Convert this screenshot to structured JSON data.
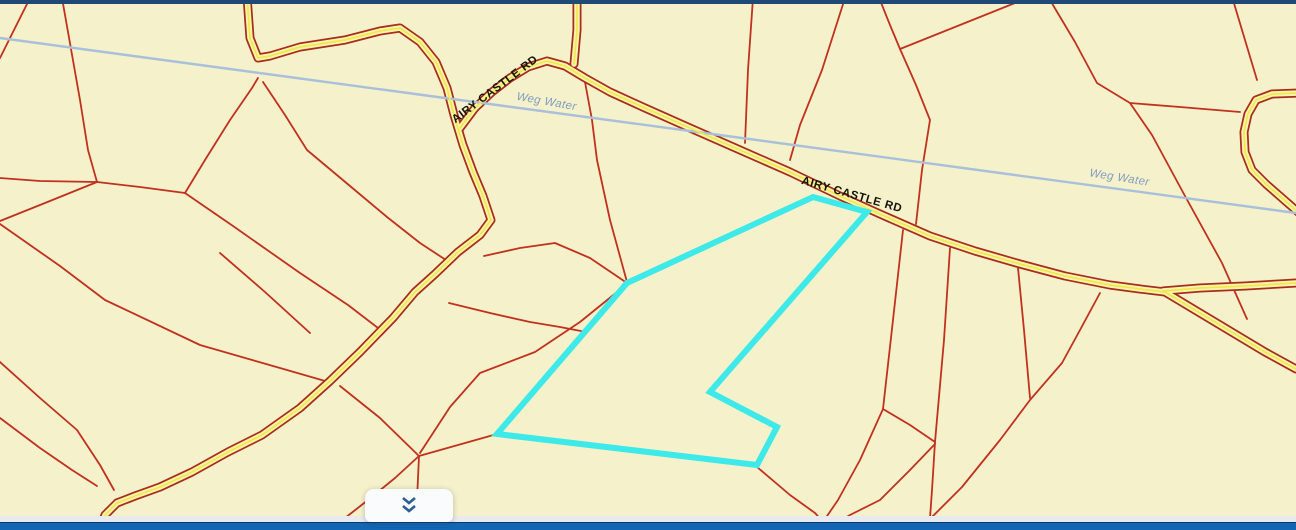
{
  "app": {
    "type": "parcel-map-viewer"
  },
  "colors": {
    "map_background": "#f5f1cb",
    "parcel_line": "#c0311f",
    "road_casing": "#a82d1c",
    "road_fill": "#f9f3ae",
    "road_centerline": "#f0e94c",
    "water_line": "#a9c0da",
    "water_label": "#7f9dc0",
    "road_label": "#141407",
    "highlight_parcel": "#3ee9e9",
    "top_bar": "#1f4a76",
    "panel_edge": "#e9eaee",
    "bottom_bar": "#1366b4",
    "bottom_bar_border": "#0a3a6e",
    "button_background": "#fafbfd",
    "chevron_icon": "#2d5f92"
  },
  "map": {
    "labels": [
      {
        "text": "AIRY CASTLE RD",
        "x": 497,
        "y": 92,
        "angle": -37,
        "kind": "road",
        "size": 11.5
      },
      {
        "text": "AIRY CASTLE RD",
        "x": 851,
        "y": 198,
        "angle": 16,
        "kind": "road",
        "size": 11.5
      },
      {
        "text": "Weg Water",
        "x": 546,
        "y": 105,
        "angle": 10,
        "kind": "water",
        "size": 11.5
      },
      {
        "text": "Weg Water",
        "x": 1119,
        "y": 181,
        "angle": 9,
        "kind": "water",
        "size": 11.5
      }
    ],
    "water": [
      [
        0,
        38
      ],
      [
        430,
        96
      ],
      [
        690,
        131
      ],
      [
        1000,
        173
      ],
      [
        1296,
        213
      ]
    ],
    "roads": [
      [
        [
          247,
          -4
        ],
        [
          250,
          38
        ],
        [
          258,
          58
        ],
        [
          270,
          56
        ],
        [
          300,
          47
        ],
        [
          345,
          40
        ],
        [
          380,
          31
        ],
        [
          400,
          28
        ],
        [
          420,
          42
        ],
        [
          436,
          62
        ],
        [
          447,
          88
        ],
        [
          454,
          115
        ],
        [
          463,
          145
        ],
        [
          473,
          172
        ],
        [
          483,
          196
        ],
        [
          491,
          220
        ],
        [
          480,
          235
        ],
        [
          458,
          252
        ],
        [
          435,
          274
        ],
        [
          415,
          292
        ],
        [
          393,
          318
        ],
        [
          360,
          352
        ],
        [
          330,
          381
        ],
        [
          300,
          408
        ],
        [
          262,
          435
        ],
        [
          228,
          452
        ],
        [
          192,
          472
        ],
        [
          160,
          487
        ],
        [
          135,
          496
        ],
        [
          117,
          503
        ],
        [
          105,
          515
        ],
        [
          99,
          532
        ]
      ],
      [
        [
          460,
          128
        ],
        [
          475,
          108
        ],
        [
          492,
          92
        ],
        [
          510,
          78
        ],
        [
          528,
          67
        ],
        [
          547,
          61
        ],
        [
          565,
          66
        ],
        [
          585,
          78
        ],
        [
          610,
          92
        ],
        [
          645,
          108
        ],
        [
          690,
          128
        ],
        [
          740,
          150
        ],
        [
          790,
          172
        ],
        [
          840,
          196
        ],
        [
          880,
          214
        ],
        [
          930,
          236
        ],
        [
          975,
          251
        ],
        [
          1020,
          264
        ],
        [
          1065,
          276
        ],
        [
          1110,
          285
        ],
        [
          1140,
          289
        ],
        [
          1165,
          292
        ],
        [
          1200,
          313
        ],
        [
          1235,
          334
        ],
        [
          1265,
          352
        ],
        [
          1296,
          369
        ]
      ],
      [
        [
          1163,
          291
        ],
        [
          1200,
          288
        ],
        [
          1245,
          286
        ],
        [
          1296,
          283
        ]
      ],
      [
        [
          577,
          -4
        ],
        [
          577,
          30
        ],
        [
          574,
          64
        ]
      ],
      [
        [
          1298,
          93
        ],
        [
          1272,
          94
        ],
        [
          1256,
          100
        ],
        [
          1248,
          114
        ],
        [
          1244,
          132
        ],
        [
          1245,
          152
        ],
        [
          1252,
          170
        ],
        [
          1266,
          184
        ],
        [
          1282,
          198
        ],
        [
          1298,
          212
        ]
      ]
    ],
    "parcel_lines": [
      [
        [
          30,
          -2
        ],
        [
          0,
          58
        ]
      ],
      [
        [
          62,
          -2
        ],
        [
          80,
          100
        ],
        [
          88,
          150
        ],
        [
          97,
          182
        ]
      ],
      [
        [
          97,
          182
        ],
        [
          40,
          181
        ],
        [
          0,
          178
        ]
      ],
      [
        [
          97,
          182
        ],
        [
          40,
          205
        ],
        [
          0,
          221
        ]
      ],
      [
        [
          0,
          224
        ],
        [
          60,
          266
        ],
        [
          105,
          300
        ],
        [
          200,
          345
        ],
        [
          280,
          368
        ],
        [
          332,
          383
        ]
      ],
      [
        [
          340,
          386
        ],
        [
          380,
          418
        ],
        [
          419,
          456
        ]
      ],
      [
        [
          419,
          456
        ],
        [
          417,
          500
        ],
        [
          417,
          522
        ]
      ],
      [
        [
          419,
          456
        ],
        [
          395,
          478
        ],
        [
          368,
          500
        ],
        [
          345,
          518
        ]
      ],
      [
        [
          419,
          456
        ],
        [
          458,
          445
        ],
        [
          497,
          434
        ]
      ],
      [
        [
          97,
          182
        ],
        [
          140,
          187
        ],
        [
          185,
          193
        ]
      ],
      [
        [
          185,
          193
        ],
        [
          233,
          226
        ],
        [
          300,
          273
        ],
        [
          348,
          305
        ],
        [
          382,
          331
        ]
      ],
      [
        [
          185,
          193
        ],
        [
          205,
          160
        ],
        [
          230,
          120
        ],
        [
          252,
          88
        ],
        [
          258,
          78
        ]
      ],
      [
        [
          220,
          253
        ],
        [
          265,
          292
        ],
        [
          310,
          333
        ]
      ],
      [
        [
          263,
          82
        ],
        [
          285,
          115
        ],
        [
          307,
          150
        ],
        [
          350,
          186
        ],
        [
          387,
          217
        ],
        [
          420,
          243
        ],
        [
          449,
          262
        ]
      ],
      [
        [
          484,
          256
        ],
        [
          520,
          248
        ],
        [
          555,
          243
        ],
        [
          590,
          258
        ],
        [
          627,
          283
        ]
      ],
      [
        [
          585,
          82
        ],
        [
          592,
          120
        ],
        [
          597,
          160
        ],
        [
          610,
          220
        ],
        [
          627,
          282
        ]
      ],
      [
        [
          449,
          303
        ],
        [
          490,
          313
        ],
        [
          530,
          322
        ],
        [
          560,
          327
        ],
        [
          586,
          332
        ]
      ],
      [
        [
          627,
          284
        ],
        [
          580,
          322
        ],
        [
          535,
          352
        ],
        [
          480,
          373
        ],
        [
          450,
          407
        ],
        [
          420,
          453
        ]
      ],
      [
        [
          845,
          -2
        ],
        [
          822,
          70
        ],
        [
          800,
          125
        ],
        [
          790,
          160
        ]
      ],
      [
        [
          753,
          -2
        ],
        [
          748,
          70
        ],
        [
          745,
          143
        ]
      ],
      [
        [
          880,
          0
        ],
        [
          890,
          25
        ],
        [
          900,
          49
        ],
        [
          916,
          85
        ],
        [
          930,
          120
        ],
        [
          922,
          170
        ],
        [
          916,
          224
        ]
      ],
      [
        [
          900,
          49
        ],
        [
          955,
          27
        ],
        [
          1015,
          3
        ]
      ],
      [
        [
          1050,
          0
        ],
        [
          1075,
          42
        ],
        [
          1097,
          83
        ],
        [
          1130,
          103
        ],
        [
          1152,
          135
        ],
        [
          1185,
          196
        ],
        [
          1222,
          263
        ],
        [
          1247,
          319
        ]
      ],
      [
        [
          1130,
          103
        ],
        [
          1180,
          107
        ],
        [
          1240,
          112
        ]
      ],
      [
        [
          1233,
          0
        ],
        [
          1245,
          40
        ],
        [
          1257,
          80
        ]
      ],
      [
        [
          1018,
          268
        ],
        [
          1024,
          330
        ],
        [
          1030,
          398
        ]
      ],
      [
        [
          1100,
          293
        ],
        [
          1080,
          330
        ],
        [
          1062,
          363
        ],
        [
          1030,
          400
        ],
        [
          1000,
          440
        ],
        [
          962,
          487
        ],
        [
          930,
          519
        ]
      ],
      [
        [
          903,
          230
        ],
        [
          893,
          320
        ],
        [
          883,
          409
        ],
        [
          860,
          460
        ],
        [
          838,
          500
        ],
        [
          825,
          519
        ],
        [
          818,
          532
        ]
      ],
      [
        [
          883,
          409
        ],
        [
          910,
          425
        ],
        [
          935,
          442
        ]
      ],
      [
        [
          950,
          248
        ],
        [
          944,
          340
        ],
        [
          935,
          442
        ],
        [
          932,
          490
        ],
        [
          929,
          532
        ]
      ],
      [
        [
          757,
          467
        ],
        [
          790,
          495
        ],
        [
          815,
          513
        ],
        [
          832,
          532
        ]
      ],
      [
        [
          820,
          532
        ],
        [
          850,
          515
        ],
        [
          880,
          500
        ],
        [
          910,
          470
        ],
        [
          935,
          444
        ]
      ],
      [
        [
          0,
          362
        ],
        [
          40,
          398
        ],
        [
          77,
          430
        ],
        [
          100,
          465
        ],
        [
          114,
          490
        ]
      ],
      [
        [
          0,
          418
        ],
        [
          40,
          448
        ],
        [
          72,
          470
        ],
        [
          97,
          486
        ]
      ]
    ],
    "highlight_parcel": [
      [
        813,
        197
      ],
      [
        867,
        212
      ],
      [
        710,
        392
      ],
      [
        777,
        427
      ],
      [
        757,
        465
      ],
      [
        497,
        434
      ],
      [
        627,
        283
      ]
    ]
  },
  "controls": {
    "expand_button_icon": "chevron-double-down"
  }
}
